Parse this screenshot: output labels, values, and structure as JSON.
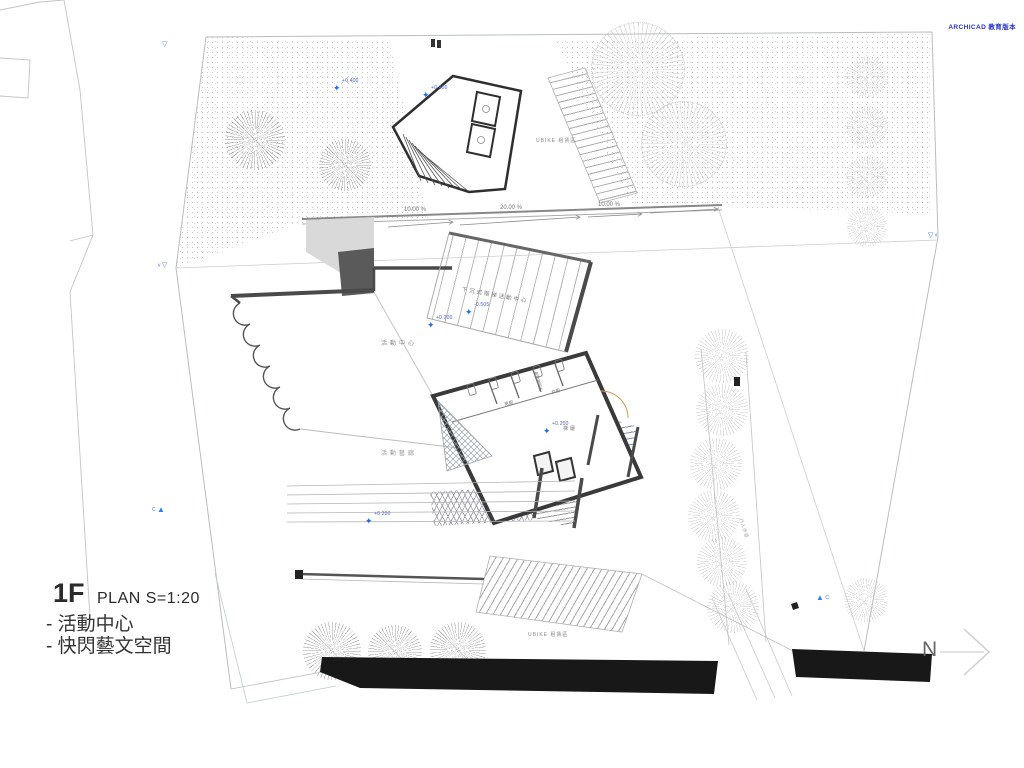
{
  "watermark": "ARCHICAD 教育版本",
  "title_block": {
    "floor": "1F",
    "plan": "PLAN S=1:20",
    "line1": "- 活動中心",
    "line2": "- 快閃藝文空間"
  },
  "north_label": "N",
  "labels": {
    "activity_center": "活動中心",
    "sunken_stair_center": "下沉式階梯活動中心",
    "activity_gallery": "活動藝廊",
    "stair_hall": "梯廳",
    "mens_toilet": "男廁",
    "womens_toilet": "女廁",
    "accessible_toilet": "無障礙廁所",
    "ubike_top": "UBIKE 租賃區",
    "ubike_bottom": "UBIKE 租賃區",
    "sidewalk": "行人步道"
  },
  "slopes": [
    "10.00 %",
    "20.00 %",
    "10.00 %"
  ],
  "levels": [
    "+0.400",
    "+0.400",
    "+0.200",
    "-0.505",
    "+0.200",
    "+0.200"
  ],
  "sections": {
    "c1": "C",
    "c2": "C",
    "v1": "v",
    "v2": "v"
  },
  "icons": {
    "level_star": "✦",
    "section_triangle": "▲",
    "datum_triangle": "▽"
  },
  "colors": {
    "accent_blue": "#2f7fe8",
    "watermark_blue": "#2732c8",
    "wall": "#4a4a4a"
  }
}
